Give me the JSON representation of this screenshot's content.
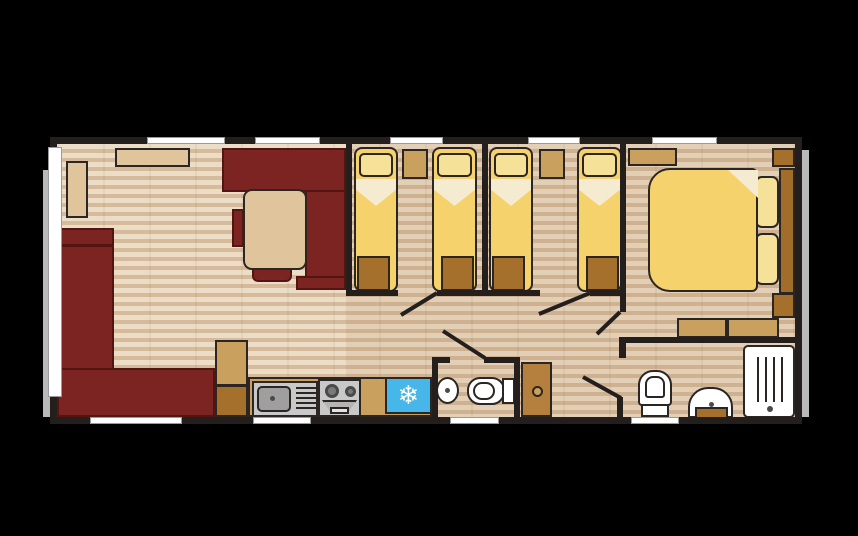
{
  "diagram_type": "static-caravan-floor-plan",
  "icons": {
    "snowflake": "❄"
  },
  "palette": {
    "bgBlack": "#000000",
    "wall": "#241f1d",
    "outerFrame": "#b9b9b9",
    "windowWhite": "#ffffff",
    "floorBase": "#ead8be",
    "sofaRed": "#7b2421",
    "sofaDark": "#521511",
    "beige": "#dfc49c",
    "bedYellow": "#f6d26c",
    "pillowYellow": "#f6e199",
    "cream": "#f4ebd0",
    "lockerBrown": "#a5702c",
    "tan": "#c9a05e",
    "woodBrown": "#b5803d",
    "headboardBrown": "#a06d2a",
    "fridgeBlue": "#47b7e9",
    "metal": "#c9c9c9",
    "metalDark": "#9f9f9f",
    "white": "#ffffff",
    "outline": "#2b2523"
  },
  "rooms": [
    {
      "name": "lounge",
      "furniture": [
        "l-shaped-sofa",
        "side-table",
        "top-shelf",
        "storage-unit"
      ]
    },
    {
      "name": "dining-area",
      "furniture": [
        "dining-table",
        "bench-seats",
        "stools"
      ]
    },
    {
      "name": "kitchen",
      "furniture": [
        "sink-with-drainer",
        "cooker-with-oven",
        "fridge",
        "worktop"
      ]
    },
    {
      "name": "twin-bedroom-1",
      "furniture": [
        "single-bed",
        "single-bed",
        "bedside-unit",
        "foot-lockers"
      ]
    },
    {
      "name": "twin-bedroom-2",
      "furniture": [
        "single-bed",
        "single-bed",
        "bedside-unit",
        "foot-lockers"
      ]
    },
    {
      "name": "wc",
      "furniture": [
        "wash-basin",
        "toilet",
        "airing-cupboard"
      ]
    },
    {
      "name": "master-bedroom",
      "furniture": [
        "double-bed",
        "headboard",
        "wardrobes",
        "dressing-units",
        "pillows"
      ]
    },
    {
      "name": "bathroom",
      "furniture": [
        "toilet",
        "wash-basin",
        "shower"
      ]
    }
  ],
  "window_count": 10,
  "door_count": 5
}
